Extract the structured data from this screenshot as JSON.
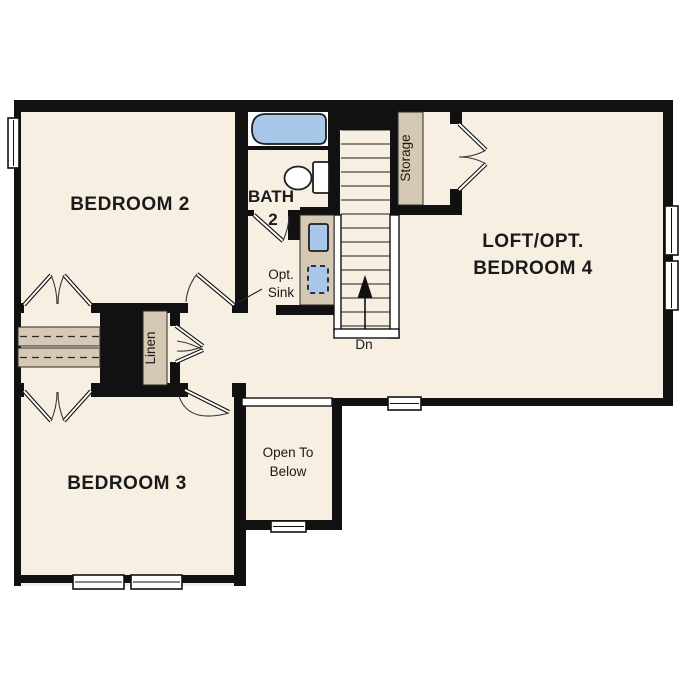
{
  "labels": {
    "bedroom2": "BEDROOM 2",
    "bedroom3": "BEDROOM 3",
    "loft_line1": "LOFT/OPT.",
    "loft_line2": "BEDROOM 4",
    "bath_line1": "BATH",
    "bath_line2": "2",
    "opt_sink_line1": "Opt.",
    "opt_sink_line2": "Sink",
    "open_below_line1": "Open To",
    "open_below_line2": "Below",
    "linen": "Linen",
    "storage": "Storage",
    "stairs_down": "Dn"
  },
  "colors": {
    "floor": "#f6efe2",
    "wall": "#111111",
    "shelf": "#d5c9b3",
    "fixture": "#a9c8e9",
    "exterior": "#ffffff",
    "text": "#1a1a1a"
  }
}
